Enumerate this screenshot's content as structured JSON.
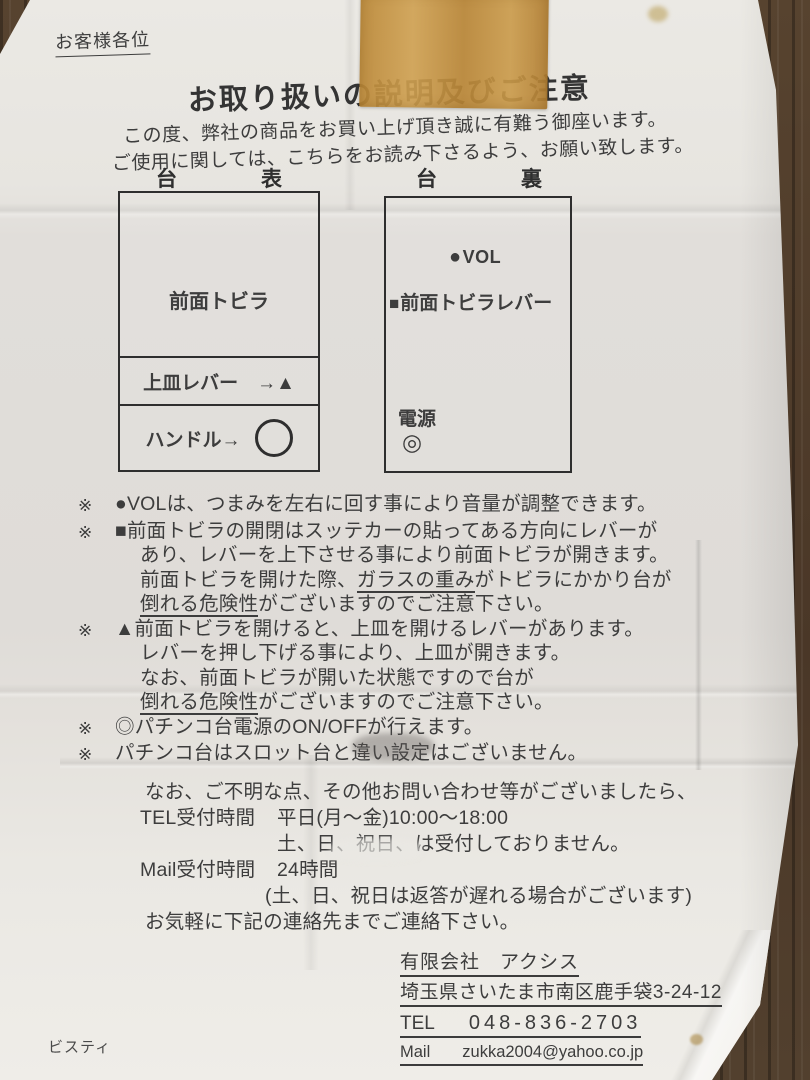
{
  "colors": {
    "wood": "#4d3a2a",
    "paper": "#e5e3de",
    "tape": "#c0913e",
    "ink": "#3d3d3d"
  },
  "header": {
    "salutation": "お客様各位",
    "title": "お取り扱いの説明及びご注意",
    "intro_line1": "この度、弊社の商品をお買い上げ頂き誠に有難う御座います。",
    "intro_line2": "ご使用に関しては、こちらをお読み下さるよう、お願い致します。"
  },
  "diagrams": {
    "front": {
      "label_left": "台",
      "label_right": "表",
      "door": "前面トビラ",
      "tray_lever": "上皿レバー　→▲",
      "handle": "ハンドル→"
    },
    "back": {
      "label_left": "台",
      "label_right": "裏",
      "vol_marker": "●",
      "vol_label": "VOL",
      "lever_marker": "■",
      "lever_label": "前面トビラレバー",
      "power_label": "電源",
      "power_marker": "◎"
    }
  },
  "notes": {
    "marker": "※",
    "n0l0": "●VOLは、つまみを左右に回す事により音量が調整できます。",
    "n1l0": "■前面トビラの開閉はスッテカーの貼ってある方向にレバーが",
    "n1l1": "あり、レバーを上下させる事により前面トビラが開きます。",
    "n1l2a": "前面トビラを開けた際、",
    "n1l2b": "ガラスの重み",
    "n1l2c": "がトビラにかかり台が",
    "n1l3a": "倒れる危険性",
    "n1l3b": "がございますのでご注意下さい。",
    "n2l0": "▲前面トビラを開けると、上皿を開けるレバーがあります。",
    "n2l1": "レバーを押し下げる事により、上皿が開きます。",
    "n2l2": "なお、前面トビラが開いた状態ですので台が",
    "n2l3a": "倒れる危険性",
    "n2l3b": "がございますのでご注意下さい。",
    "n3l0": "◎パチンコ台電源のON/OFFが行えます。",
    "n4l0": "パチンコ台はスロット台と違い設定はございません。"
  },
  "contact": {
    "intro": "なお、ご不明な点、その他お問い合わせ等がございましたら、",
    "tel_label": "TEL受付時間",
    "tel_hours": "平日(月～金)10:00～18:00",
    "tel_closed": "土、日、祝日、は受付しておりません。",
    "mail_label": "Mail受付時間",
    "mail_hours": "24時間",
    "mail_note": "(土、日、祝日は返答が遅れる場合がございます)",
    "closing": "お気軽に下記の連絡先までご連絡下さい。"
  },
  "company": {
    "name": "有限会社　アクシス",
    "address": "埼玉県さいたま市南区鹿手袋3-24-12",
    "tel_label": "TEL",
    "tel_number": "048-836-2703",
    "mail_label": "Mail",
    "mail_address": "zukka2004@yahoo.co.jp"
  },
  "footer": {
    "maker": "ビスティ"
  }
}
